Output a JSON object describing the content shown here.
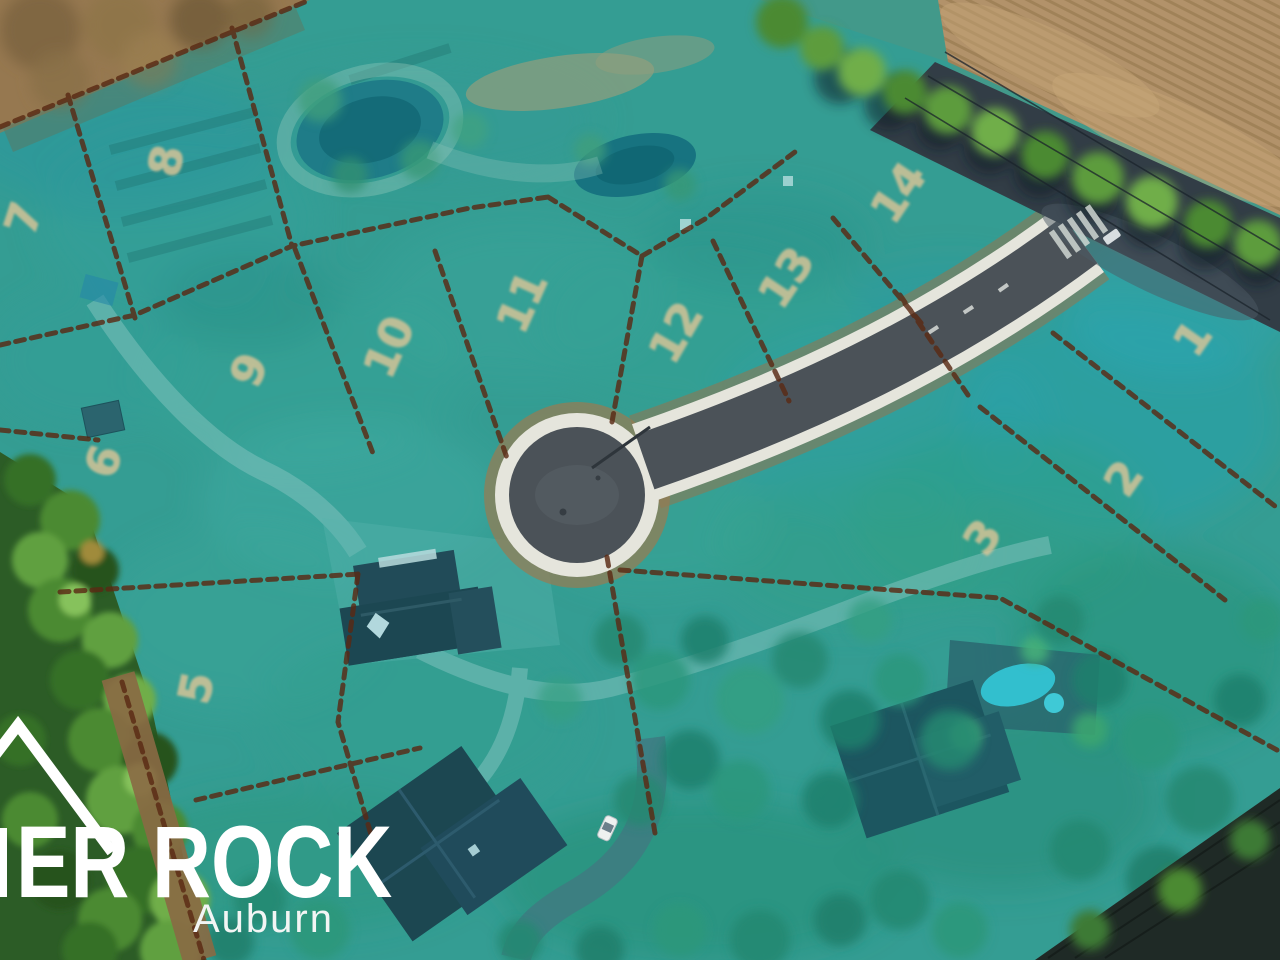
{
  "branding": {
    "name_partial": "ER ROCK",
    "subtitle": "Auburn",
    "text_color": "#ffffff",
    "mark": "mountain-peak-outline"
  },
  "lots": [
    {
      "label": "1",
      "x": 1205,
      "y": 347,
      "rot": -55
    },
    {
      "label": "2",
      "x": 1136,
      "y": 487,
      "rot": -55
    },
    {
      "label": "3",
      "x": 995,
      "y": 546,
      "rot": -55
    },
    {
      "label": "5",
      "x": 211,
      "y": 691,
      "rot": -78
    },
    {
      "label": "6",
      "x": 118,
      "y": 466,
      "rot": -72
    },
    {
      "label": "7",
      "x": 38,
      "y": 223,
      "rot": -72
    },
    {
      "label": "8",
      "x": 181,
      "y": 164,
      "rot": -78
    },
    {
      "label": "9",
      "x": 263,
      "y": 376,
      "rot": -66
    },
    {
      "label": "10",
      "x": 403,
      "y": 353,
      "rot": -66
    },
    {
      "label": "11",
      "x": 536,
      "y": 308,
      "rot": -66
    },
    {
      "label": "12",
      "x": 689,
      "y": 340,
      "rot": -60
    },
    {
      "label": "13",
      "x": 799,
      "y": 286,
      "rot": -56
    },
    {
      "label": "14",
      "x": 911,
      "y": 201,
      "rot": -56
    }
  ],
  "colors": {
    "overlay_teal": "#00aeb9",
    "lot_line": "#5a2a14",
    "lot_number": "#ddc697",
    "asphalt": "#4b5258",
    "sidewalk": "#e5e5dc",
    "plowed_field": "#b2926a",
    "forest_green": "#2c5c26",
    "pond_water": "#1d6472",
    "pool_water": "#3fc3d4",
    "brand_white": "#ffffff"
  },
  "features": {
    "site": "aerial-lot-map",
    "road": "cul-de-sac-street",
    "water": [
      "west-pond",
      "east-pond",
      "swimming-pool"
    ],
    "buildings": [
      "center-house",
      "south-house",
      "pool-house",
      "shed"
    ],
    "vehicle": "white-car"
  }
}
